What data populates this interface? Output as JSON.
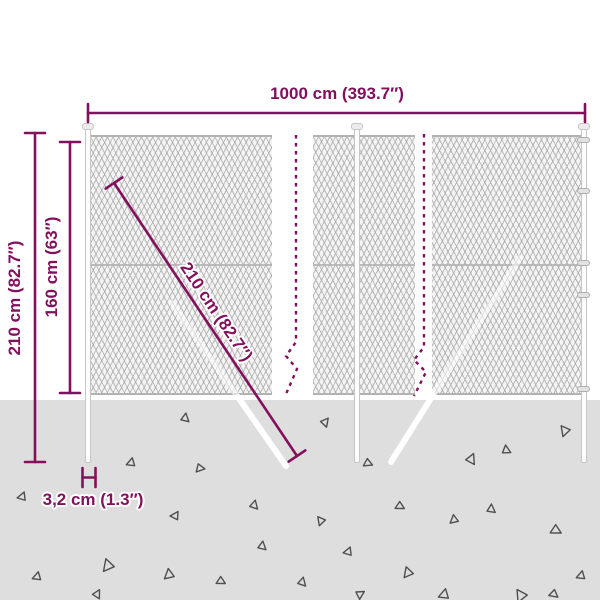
{
  "title": "Chain-link fence dimension diagram",
  "colors": {
    "accent": "#83105c",
    "ground": "#dedede",
    "mesh-bg": "#f4f4f4",
    "mesh-line": "#bfbfbf",
    "panel-edge": "#b2b2b2",
    "post-fill": "#fdfdfd",
    "post-border": "#c6c6c6",
    "triangle": "#4f4f4f"
  },
  "dims": {
    "width": {
      "label": "1000 cm (393.7″)"
    },
    "total_height": {
      "label": "210 cm (82.7″)"
    },
    "mesh_height": {
      "label": "160 cm (63″)"
    },
    "diagonal": {
      "label": "210 cm (82.7″)"
    },
    "post_width": {
      "label": "3,2 cm (1.3″)"
    }
  },
  "ground": {
    "triangles": [
      {
        "x": 185,
        "y": 418,
        "s": 5,
        "r": 10
      },
      {
        "x": 325,
        "y": 422,
        "s": 5,
        "r": 40
      },
      {
        "x": 565,
        "y": 431,
        "s": 6,
        "r": 200
      },
      {
        "x": 131,
        "y": 463,
        "s": 5,
        "r": 250
      },
      {
        "x": 200,
        "y": 468,
        "s": 5,
        "r": 100
      },
      {
        "x": 368,
        "y": 463,
        "s": 5,
        "r": 115
      },
      {
        "x": 471,
        "y": 459,
        "s": 6,
        "r": 25
      },
      {
        "x": 506,
        "y": 450,
        "s": 5,
        "r": 355
      },
      {
        "x": 22,
        "y": 497,
        "s": 5,
        "r": 260
      },
      {
        "x": 254,
        "y": 505,
        "s": 5,
        "r": 15
      },
      {
        "x": 400,
        "y": 506,
        "s": 5,
        "r": 120
      },
      {
        "x": 491,
        "y": 509,
        "s": 5,
        "r": 5
      },
      {
        "x": 454,
        "y": 520,
        "s": 5,
        "r": 230
      },
      {
        "x": 175,
        "y": 516,
        "s": 5,
        "r": 270
      },
      {
        "x": 321,
        "y": 521,
        "s": 5,
        "r": 200
      },
      {
        "x": 556,
        "y": 530,
        "s": 6,
        "r": 120
      },
      {
        "x": 262,
        "y": 546,
        "s": 5,
        "r": 10
      },
      {
        "x": 348,
        "y": 552,
        "s": 5,
        "r": 260
      },
      {
        "x": 108,
        "y": 566,
        "s": 7,
        "r": 220
      },
      {
        "x": 37,
        "y": 577,
        "s": 5,
        "r": 250
      },
      {
        "x": 169,
        "y": 575,
        "s": 6,
        "r": 230
      },
      {
        "x": 221,
        "y": 581,
        "s": 5,
        "r": 120
      },
      {
        "x": 302,
        "y": 582,
        "s": 5,
        "r": 15
      },
      {
        "x": 444,
        "y": 595,
        "s": 6,
        "r": 250
      },
      {
        "x": 521,
        "y": 596,
        "s": 7,
        "r": 205
      },
      {
        "x": 554,
        "y": 594,
        "s": 5,
        "r": 130
      },
      {
        "x": 581,
        "y": 576,
        "s": 5,
        "r": 250
      },
      {
        "x": 408,
        "y": 573,
        "s": 6,
        "r": 220
      },
      {
        "x": 360,
        "y": 594,
        "s": 5,
        "r": 60
      },
      {
        "x": 97,
        "y": 594,
        "s": 5,
        "r": 30
      }
    ]
  }
}
